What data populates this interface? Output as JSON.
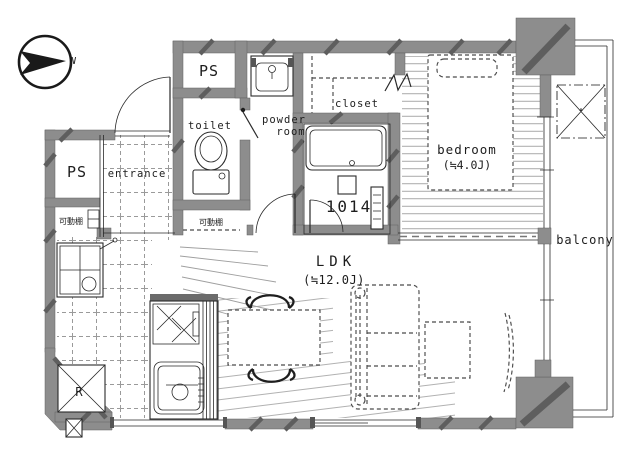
{
  "plan": {
    "compass": {
      "north_label": "N"
    },
    "labels": {
      "ps_top": "PS",
      "ps_left": "PS",
      "toilet": "toilet",
      "powder_line1": "powder",
      "powder_line2": "room",
      "closet": "closet",
      "bedroom_name": "bedroom",
      "bedroom_size": "(≒4.0J)",
      "bath_unit_size": "1014",
      "entrance": "entrance",
      "shelf_left": "可動棚",
      "shelf_hall": "可動棚",
      "ldk_name": "LDK",
      "ldk_size": "(≒12.0J)",
      "balcony": "balcony",
      "refrigerator": "R"
    },
    "colors": {
      "wall": "#8d8d8d",
      "wall-dark": "#5e5e5e",
      "line": "#2a2a2a",
      "floor-line": "#9f9f9f",
      "dash": "#4a4a4a",
      "bg": "#ffffff"
    }
  }
}
